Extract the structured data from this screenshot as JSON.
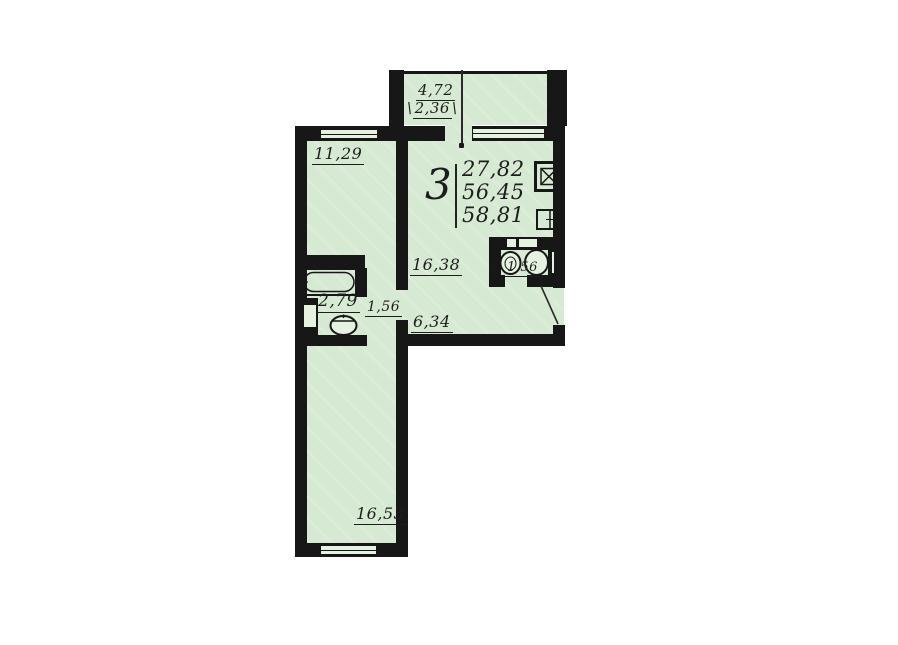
{
  "legend": {
    "room_count": "3",
    "areas": [
      "27,82",
      "56,45",
      "58,81"
    ]
  },
  "dimensions": {
    "balcony": {
      "upper": "4,72",
      "lower": "2,36",
      "slash": "\\"
    },
    "room_top": "11,29",
    "living": "16,38",
    "bathroom": "2,79",
    "corridor": "1,56",
    "hallway": "6,34",
    "wc": "1,56",
    "room_bottom": "16,53"
  },
  "icons": {
    "elevator": "elevator-shaft",
    "garbage_chute": "garbage-chute",
    "entrance": "door-swing"
  },
  "colors": {
    "background": "#ffffff",
    "floor": "#d6e9d2",
    "wall": "#171717",
    "text": "#1d1d1d"
  }
}
